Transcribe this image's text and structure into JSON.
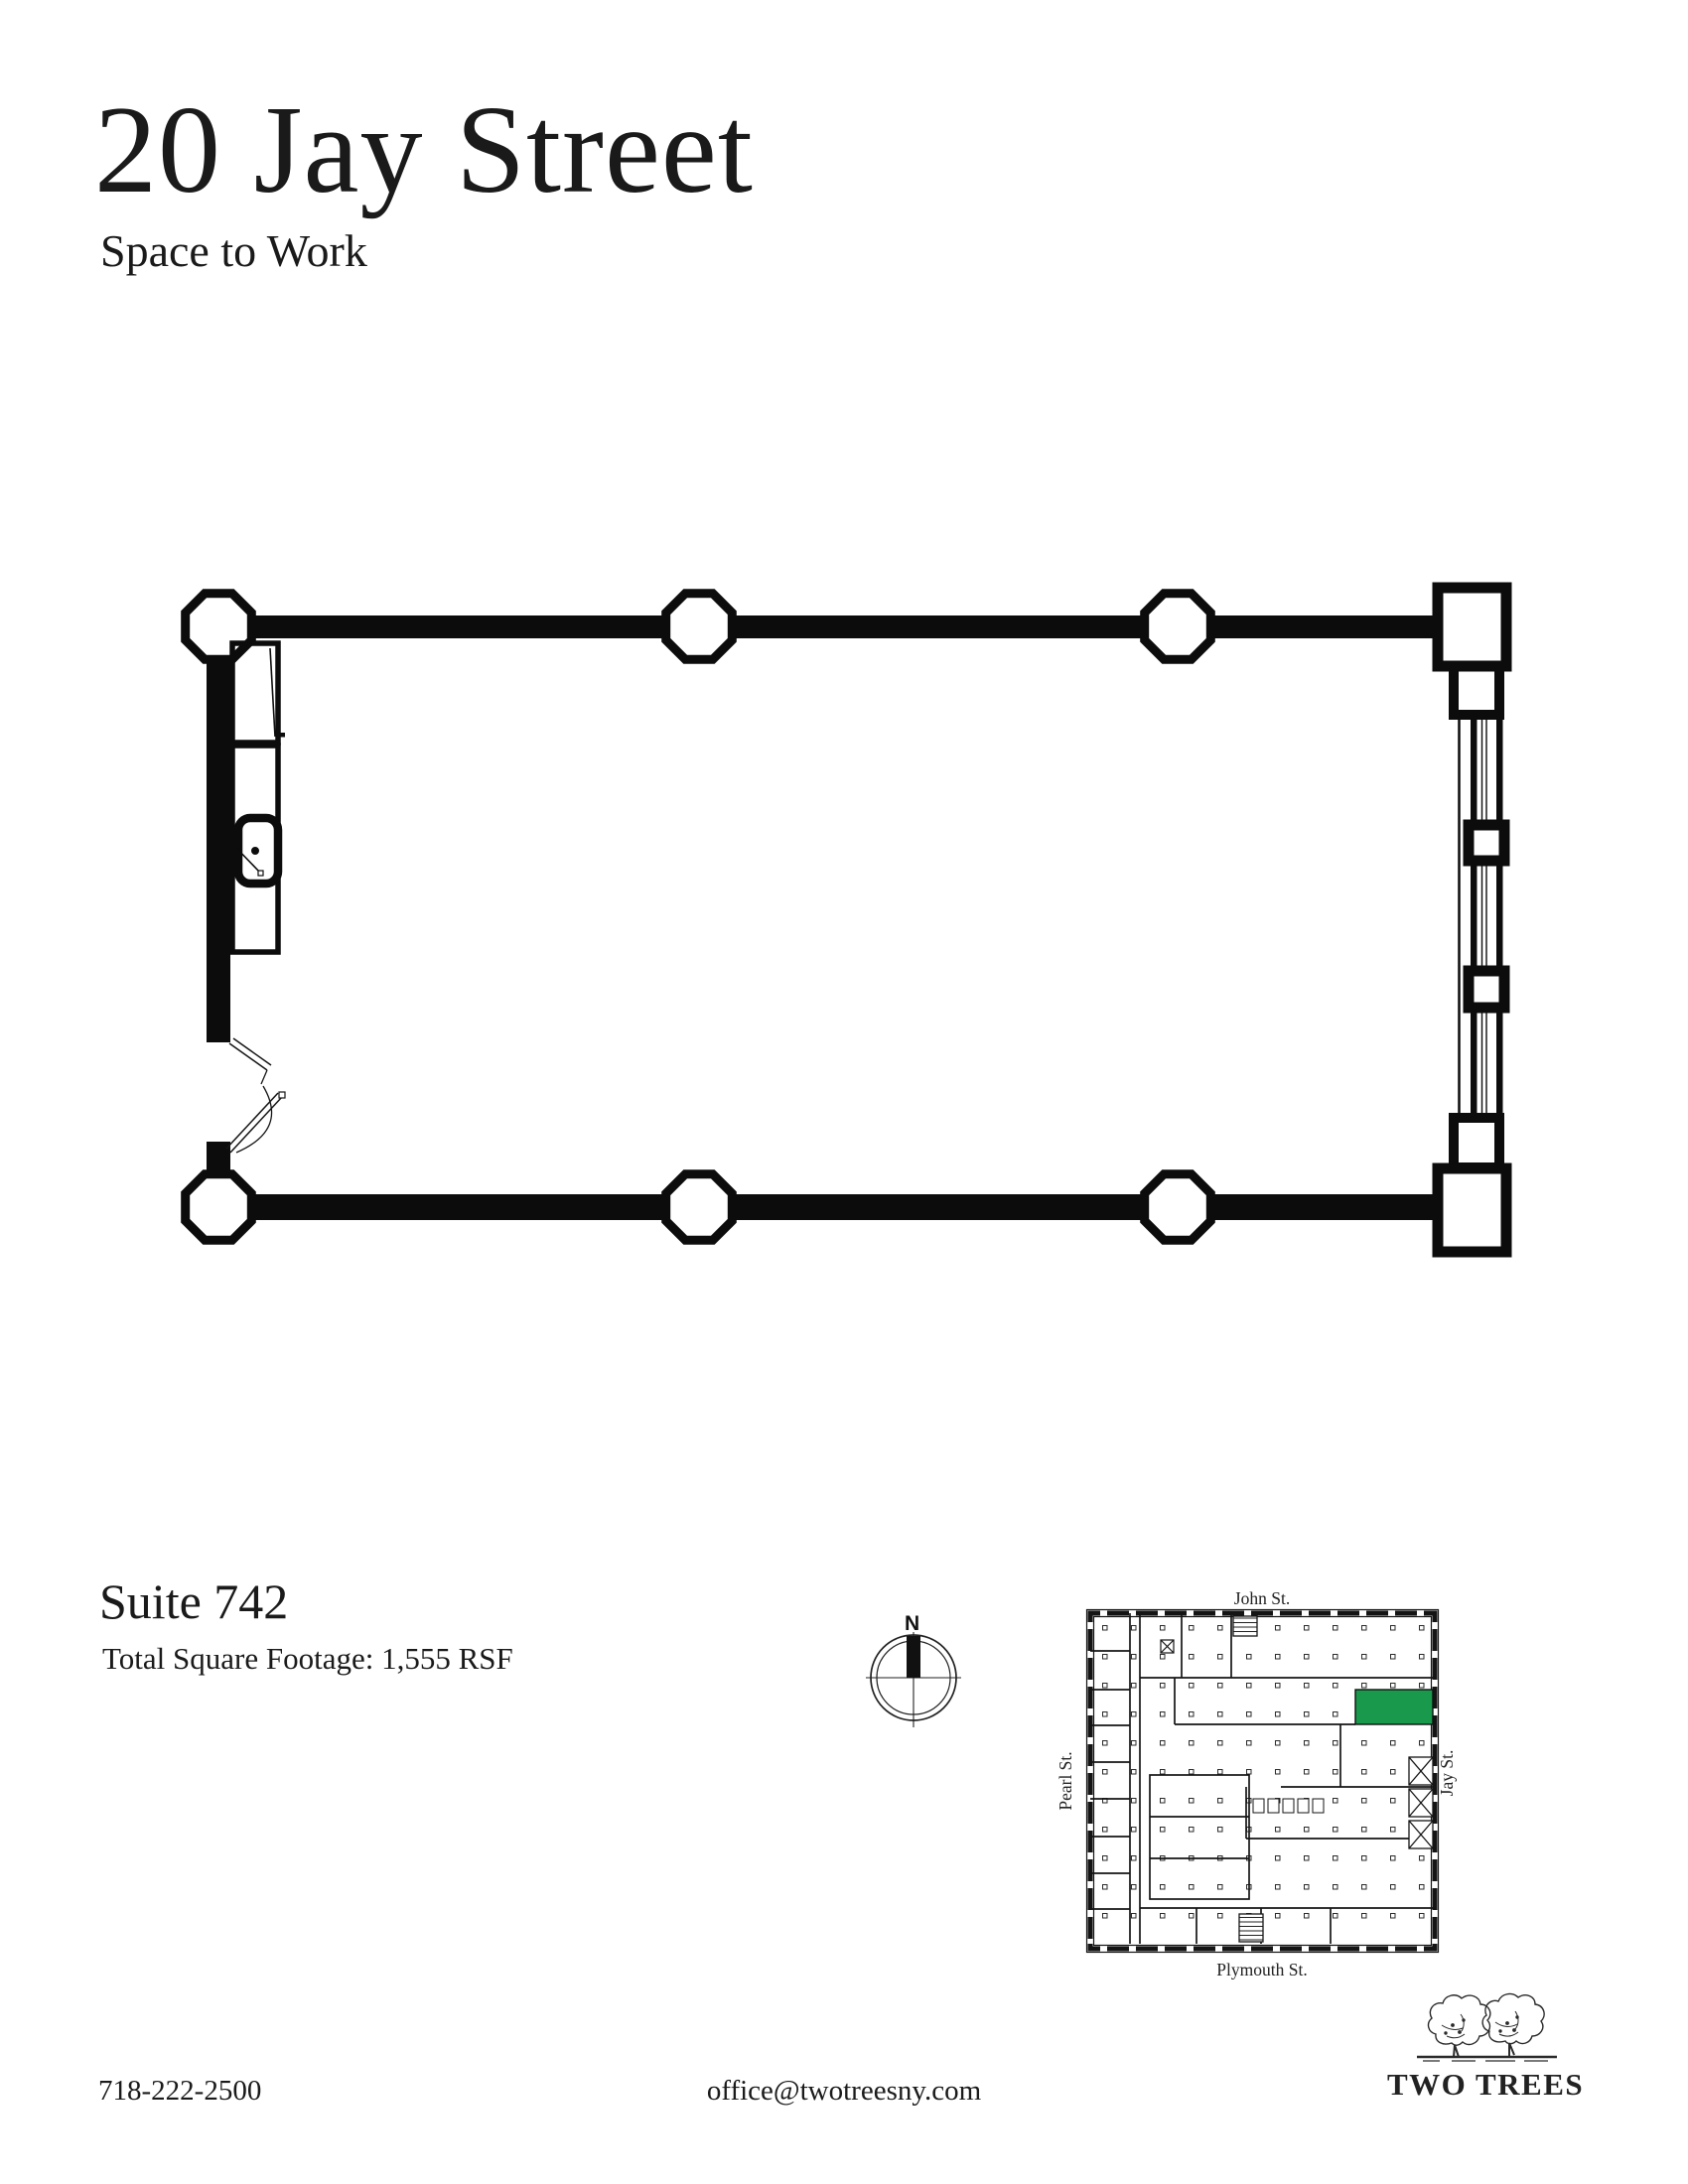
{
  "page": {
    "background_color": "#ffffff",
    "ink_color": "#1a1a1a"
  },
  "header": {
    "title": "20 Jay Street",
    "subtitle": "Space to Work"
  },
  "suite": {
    "name": "Suite 742",
    "square_footage": "Total Square Footage: 1,555 RSF"
  },
  "compass": {
    "north_label": "N"
  },
  "keyplan": {
    "streets": {
      "top": "John St.",
      "left": "Pearl St.",
      "right": "Jay St.",
      "bottom": "Plymouth St."
    },
    "highlight_color": "#18994b"
  },
  "footer": {
    "phone": "718-222-2500",
    "email": "office@twotreesny.com",
    "logo_text": "TWO TREES"
  }
}
